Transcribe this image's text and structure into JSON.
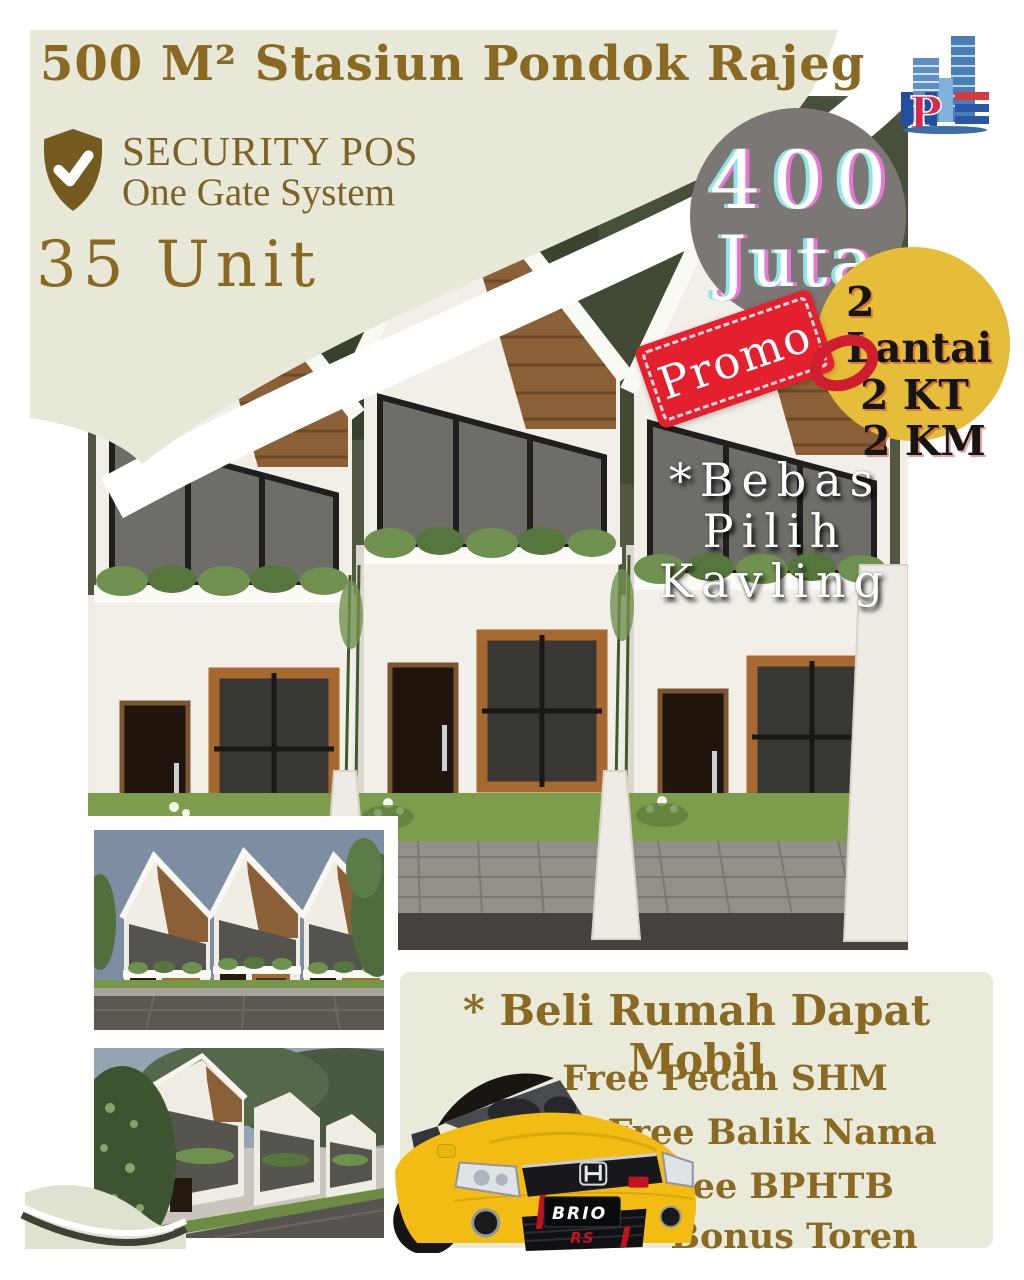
{
  "colors": {
    "background": "#ffffff",
    "sage_panel": "#e7e8d8",
    "gold_text": "#8a6a22",
    "price_badge_bg": "#7b7774",
    "spec_badge_bg": "#e6bd39",
    "promo_bg": "#e5202e",
    "car_yellow": "#f2bc13"
  },
  "header": {
    "title": "500 M² Stasiun Pondok Rajeg",
    "security_title": "SECURITY POS",
    "security_subtitle": "One Gate System",
    "units": "35 Unit"
  },
  "price_badge": {
    "amount": "400",
    "currency": "Juta"
  },
  "spec_badge": {
    "floors": "2 Lantai",
    "bedrooms": "2 KT",
    "bathrooms": "2 KM"
  },
  "promo_tag": {
    "label": "Promo"
  },
  "plot_note": {
    "line1": "*Bebas",
    "line2": "Pilih",
    "line3": "Kavling"
  },
  "offer": {
    "title": "* Beli Rumah Dapat Mobil",
    "items": [
      "Free Pecah SHM",
      "Free Balik Nama",
      "Free BPHTB",
      "Bonus Toren"
    ]
  },
  "car": {
    "badge": "BRIO",
    "trim": "RS"
  }
}
